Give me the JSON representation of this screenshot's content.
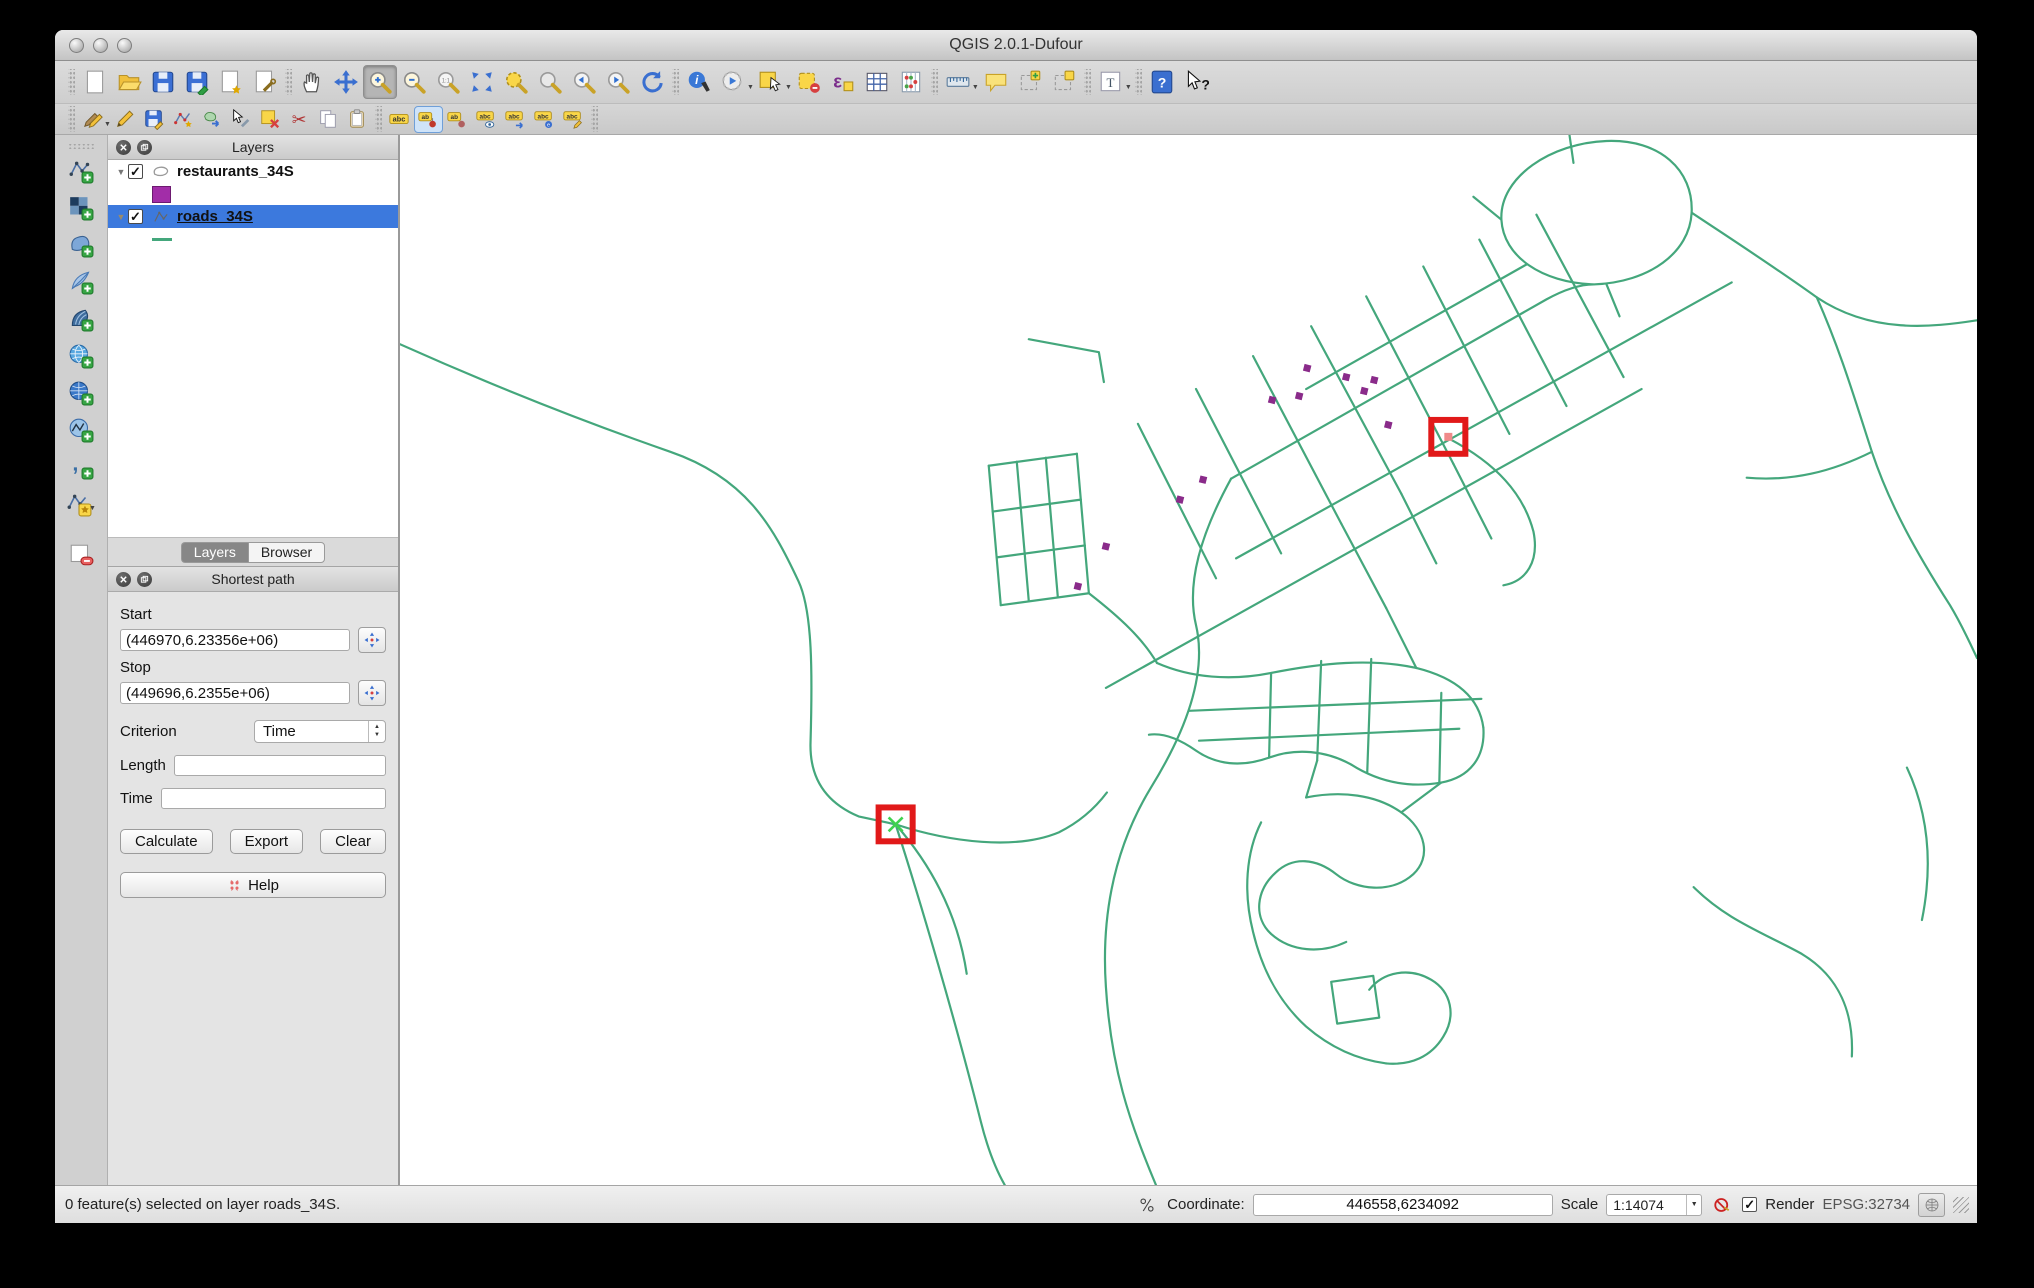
{
  "window": {
    "title": "QGIS 2.0.1-Dufour"
  },
  "toolbar_main": {
    "icons": [
      "new-project",
      "open-project",
      "save-project",
      "save-project-as",
      "new-composer",
      "composer-manager",
      "pan-map",
      "pan-to-selection",
      "zoom-in",
      "zoom-out",
      "zoom-actual",
      "zoom-full",
      "zoom-to-selection",
      "zoom-to-layer",
      "zoom-last",
      "zoom-next",
      "refresh",
      "identify",
      "run-feature-action",
      "select-features",
      "deselect-features",
      "select-by-expression",
      "attribute-table",
      "field-calculator",
      "measure",
      "map-tips",
      "new-bookmark",
      "show-bookmarks",
      "text-annotation",
      "help-contents",
      "whats-this"
    ]
  },
  "toolbar_digitizing": {
    "icons": [
      "current-edits",
      "toggle-editing",
      "save-layer-edits",
      "add-feature",
      "move-feature",
      "node-tool",
      "delete-selected",
      "cut-features",
      "copy-features",
      "paste-features",
      "layer-labeling",
      "label-pin",
      "label-move",
      "label-visibility",
      "label-arrow",
      "label-properties",
      "label-edit"
    ]
  },
  "toolbar_layers": {
    "icons": [
      "add-vector-layer",
      "add-raster-layer",
      "add-postgis-layer",
      "add-spatialite-layer",
      "add-mssql-layer",
      "add-wms-layer",
      "add-wcs-layer",
      "add-wfs-layer",
      "add-delimited-text-layer",
      "new-shapefile-layer",
      "remove-layer"
    ]
  },
  "layers_panel": {
    "title": "Layers",
    "items": [
      {
        "label": "restaurants_34S",
        "checked": true,
        "type": "point",
        "swatch_color": "#a22da8"
      },
      {
        "label": "roads_34S",
        "checked": true,
        "selected": true,
        "type": "line",
        "swatch_color": "#44a77c"
      }
    ],
    "tabs": [
      {
        "label": "Layers"
      },
      {
        "label": "Browser"
      }
    ]
  },
  "shortest_path_panel": {
    "title": "Shortest path",
    "start_label": "Start",
    "start_value": "(446970,6.23356e+06)",
    "stop_label": "Stop",
    "stop_value": "(449696,6.2355e+06)",
    "criterion_label": "Criterion",
    "criterion_value": "Time",
    "length_label": "Length",
    "length_value": "",
    "time_label": "Time",
    "time_value": "",
    "buttons": {
      "calculate": "Calculate",
      "export": "Export",
      "clear": "Clear",
      "help": "Help"
    }
  },
  "status_bar": {
    "message": "0 feature(s) selected on layer roads_34S.",
    "coordinate_label": "Coordinate:",
    "coordinate_value": "446558,6234092",
    "scale_label": "Scale",
    "scale_value": "1:14074",
    "render_label": "Render",
    "crs": "EPSG:32734"
  },
  "map": {
    "road_color": "#44a77c",
    "restaurant_color": "#8a2b8a",
    "marker_color": "#e11919",
    "start_cross_color": "#3fd24f",
    "stop_dot_color": "#f08a8a",
    "roads": [
      "M0,210 C100,255 190,290 270,318 C345,344 372,392 398,448 C412,478 412,540 410,610 C409,645 425,670 458,684 L495,692",
      "M495,692 C520,770 555,890 580,990 C588,1022 596,1040 604,1054",
      "M495,692 C550,710 615,718 658,700 C678,690 694,676 706,660",
      "M495,692 C535,738 558,788 566,842",
      "M830,345 C800,400 785,450 795,492 C805,535 790,590 750,655 C715,713 700,780 705,855 C710,935 728,990 755,1054",
      "M830,345 L1145,165 C1165,154 1180,150 1192,150",
      "M835,425 L1330,148",
      "M705,555 L1240,255",
      "M905,255 L1125,130",
      "M795,255 L880,420",
      "M852,222 L940,390",
      "M910,192 L1000,360",
      "M965,162 L1052,330",
      "M1022,132 L1108,300",
      "M1078,105 L1165,272",
      "M1135,80 L1222,243",
      "M737,290 L815,445",
      "M940,390 L985,475",
      "M1052,330 L1090,405",
      "M1000,360 L1035,430",
      "M985,475 C995,495 1005,515 1015,535",
      "M588,332 L600,472",
      "M616,328 L628,468",
      "M645,324 L657,464",
      "M676,320 L688,460",
      "M588,332 L676,320",
      "M592,378 L680,366",
      "M596,424 L684,412",
      "M600,472 L688,460",
      "M688,460 C720,485 742,506 756,530",
      "M1192,150 C1140,148 1102,122 1100,85 C1098,42 1150,8 1205,6 C1258,4 1292,35 1290,78 C1288,118 1248,148 1192,150 Z",
      "M1168,0 L1172,28",
      "M1290,78 C1335,108 1372,132 1415,163 C1470,200 1530,193 1575,186",
      "M1415,163 C1438,215 1452,262 1470,318 C1488,372 1515,420 1548,472 C1560,492 1568,510 1575,525",
      "M1470,318 C1430,338 1390,348 1345,344",
      "M1048,305 C1095,330 1122,360 1132,398 C1138,428 1125,448 1102,452",
      "M1292,755 C1325,788 1360,800 1400,822 C1438,845 1452,882 1450,925",
      "M1505,635 C1525,678 1532,728 1520,788",
      "M628,205 L698,218 L703,248",
      "M756,530 C790,545 830,548 870,540 C920,530 970,525 1015,535 C1055,545 1078,565 1082,595",
      "M1082,595 C1084,625 1068,645 1040,650 C1005,656 975,648 950,632",
      "M950,632 C925,618 895,615 868,625 C840,635 815,632 795,618 C778,606 762,600 748,602",
      "M870,540 L868,625",
      "M920,528 L916,628",
      "M970,526 L966,640",
      "M1040,560 L1038,650",
      "M788,578 L1080,566",
      "M798,608 L1058,596",
      "M905,665 C940,658 975,662 1000,680 C1025,698 1030,725 1012,742 C990,762 955,758 935,742 C915,726 892,724 875,740 C855,758 852,785 870,802 C890,820 920,822 945,810",
      "M860,690 C845,720 842,760 852,800 C862,842 880,872 905,895 C928,915 955,928 985,932",
      "M985,932 C1010,934 1030,925 1042,905 C1055,884 1050,860 1030,848 C1008,835 982,840 968,858",
      "M1000,680 L1040,650",
      "M905,665 L916,628",
      "M930,850 L972,844 L978,886 L936,892 Z",
      "M1205,150 L1218,182",
      "M1100,85 L1072,62"
    ],
    "restaurants": [
      [
        906,
        234
      ],
      [
        945,
        243
      ],
      [
        973,
        246
      ],
      [
        963,
        257
      ],
      [
        871,
        266
      ],
      [
        898,
        262
      ],
      [
        987,
        291
      ],
      [
        802,
        346
      ],
      [
        779,
        366
      ],
      [
        705,
        413
      ],
      [
        677,
        453
      ]
    ],
    "markers": {
      "start": {
        "x": 478,
        "y": 675,
        "size": 34
      },
      "stop": {
        "x": 1030,
        "y": 286,
        "size": 34
      }
    }
  }
}
